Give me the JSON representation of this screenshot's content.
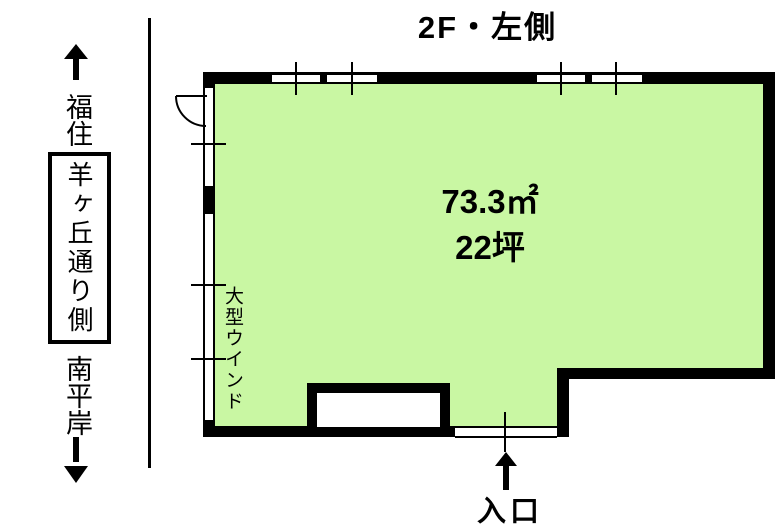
{
  "title": "2F・左側",
  "colors": {
    "room_fill": "#C9F7A3",
    "wall": "#000000"
  },
  "street_legend": {
    "north_label": "福住",
    "street_name": "羊ヶ丘通り側",
    "south_label": "南平岸"
  },
  "room": {
    "area_m2": "73.3㎡",
    "area_tsubo": "22坪",
    "window_note": "大型ウインド",
    "entrance_label": "入口"
  },
  "icons": {
    "north_arrow": "↑",
    "south_arrow": "↓",
    "entrance_arrow": "↑"
  }
}
